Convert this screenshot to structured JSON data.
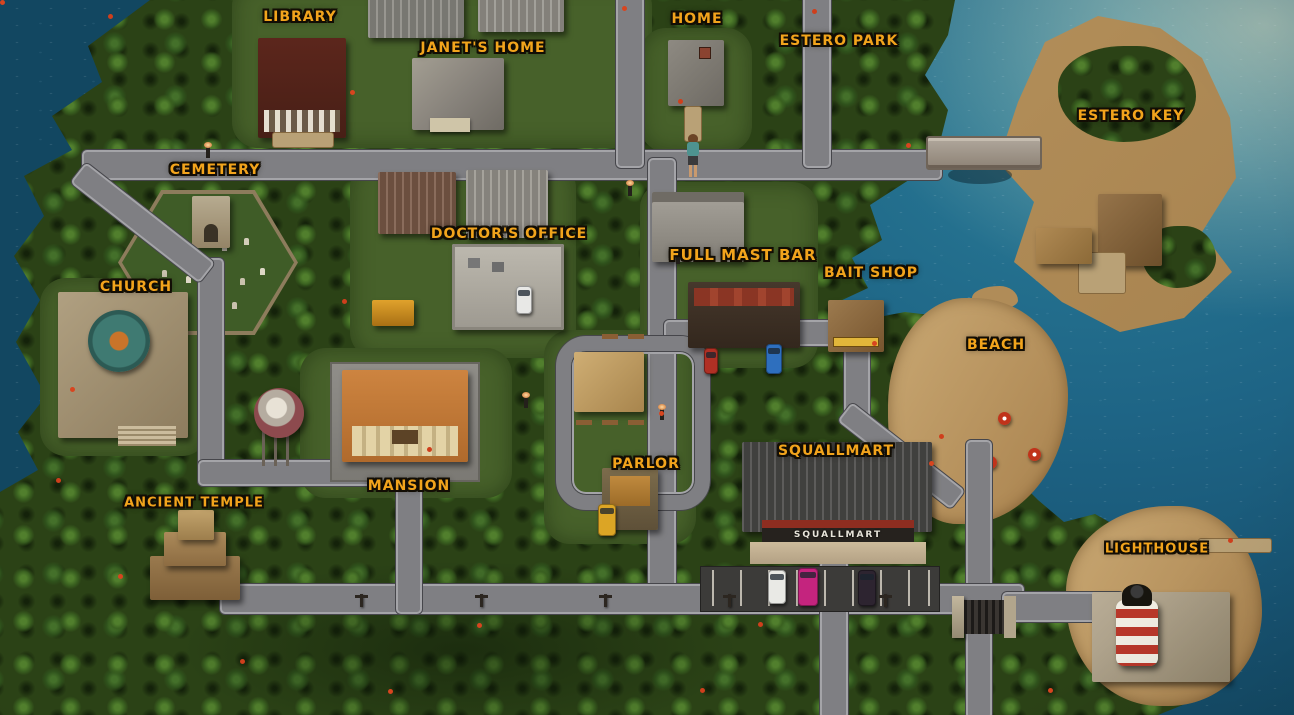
{
  "game_map": {
    "region_name": "Estero Key island town map",
    "locations": [
      {
        "id": "library",
        "label": "LIBRARY",
        "x": 300,
        "y": 17,
        "size": 14
      },
      {
        "id": "janets-home",
        "label": "JANET'S HOME",
        "x": 483,
        "y": 48,
        "size": 14
      },
      {
        "id": "home",
        "label": "HOME",
        "x": 697,
        "y": 19,
        "size": 14
      },
      {
        "id": "estero-park",
        "label": "ESTERO PARK",
        "x": 839,
        "y": 41,
        "size": 14
      },
      {
        "id": "estero-key",
        "label": "ESTERO KEY",
        "x": 1131,
        "y": 116,
        "size": 14
      },
      {
        "id": "cemetery",
        "label": "CEMETERY",
        "x": 215,
        "y": 170,
        "size": 14
      },
      {
        "id": "doctors-office",
        "label": "DOCTOR'S OFFICE",
        "x": 509,
        "y": 234,
        "size": 14
      },
      {
        "id": "full-mast-bar",
        "label": "FULL MAST BAR",
        "x": 743,
        "y": 255,
        "size": 15
      },
      {
        "id": "bait-shop",
        "label": "BAIT SHOP",
        "x": 871,
        "y": 273,
        "size": 14
      },
      {
        "id": "church",
        "label": "CHURCH",
        "x": 136,
        "y": 287,
        "size": 14
      },
      {
        "id": "beach",
        "label": "BEACH",
        "x": 996,
        "y": 345,
        "size": 14
      },
      {
        "id": "mansion",
        "label": "MANSION",
        "x": 409,
        "y": 486,
        "size": 14
      },
      {
        "id": "ancient-temple",
        "label": "ANCIENT TEMPLE",
        "x": 194,
        "y": 503,
        "size": 13
      },
      {
        "id": "parlor",
        "label": "PARLOR",
        "x": 646,
        "y": 464,
        "size": 14
      },
      {
        "id": "squallmart",
        "label": "SQUALLMART",
        "x": 836,
        "y": 451,
        "size": 14
      },
      {
        "id": "lighthouse",
        "label": "LIGHTHOUSE",
        "x": 1157,
        "y": 549,
        "size": 13
      }
    ],
    "signs": {
      "squallmart_storefront": "SQUALLMART"
    },
    "colors": {
      "water": "#1e6485",
      "water_deep": "#124761",
      "jungle": "#2b4216",
      "lawn": "#47612a",
      "sand": "#b99562",
      "road": "#7f7f83",
      "label_gold": "#f2a41c",
      "label_outline": "#120d04"
    }
  }
}
